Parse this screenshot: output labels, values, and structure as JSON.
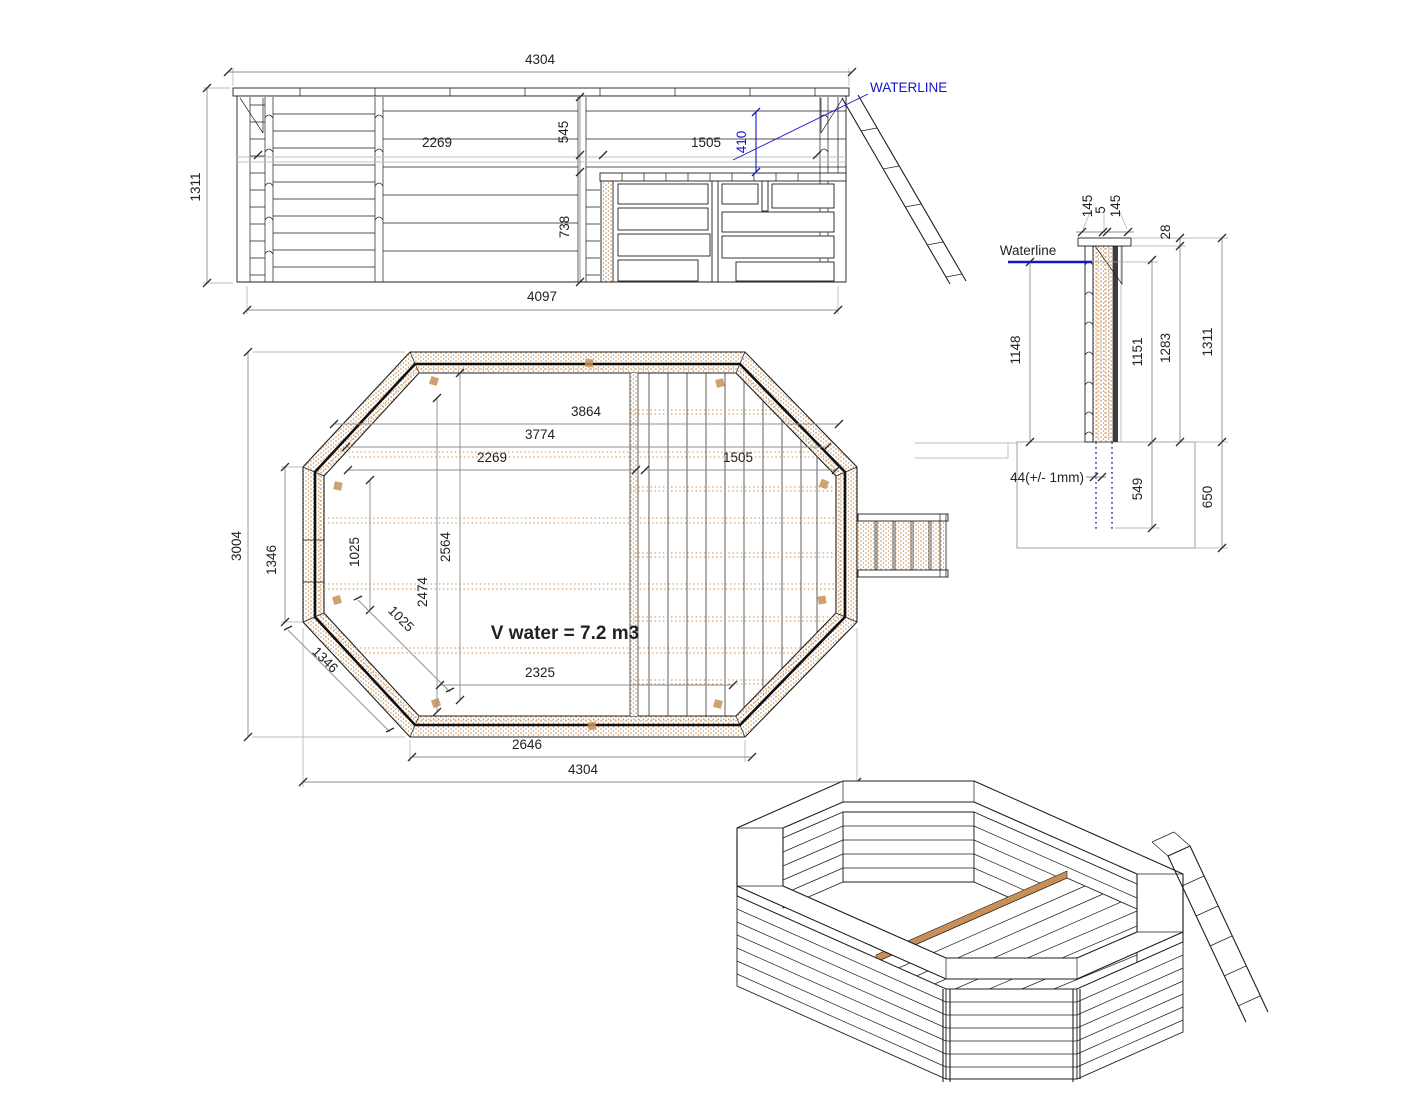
{
  "drawing": {
    "elevation": {
      "total_width": "4304",
      "height": "1311",
      "span_left": "2269",
      "depth_top": "545",
      "span_right": "1505",
      "waterline_offset": "410",
      "depth_bottom": "738",
      "bottom_width": "4097",
      "waterline_label": "WATERLINE"
    },
    "plan": {
      "w3864": "3864",
      "w3774": "3774",
      "w2269": "2269",
      "w1505": "1505",
      "h3004": "3004",
      "edge_left_1346": "1346",
      "v1025": "1025",
      "diag1025": "1025",
      "diag1346": "1346",
      "h2564": "2564",
      "h2474": "2474",
      "volume_note": "V water = 7.2 m3",
      "b2325": "2325",
      "b2646": "2646",
      "b4304": "4304"
    },
    "section": {
      "cap145a": "145",
      "cap5": "5",
      "cap145b": "145",
      "t28": "28",
      "waterline_label": "Waterline",
      "d1148": "1148",
      "d1151": "1151",
      "d1283": "1283",
      "d1311": "1311",
      "d44": "44(+/- 1mm)",
      "d549": "549",
      "d650": "650"
    }
  },
  "colors": {
    "line": "#1f1f1f",
    "dimension": "#8c8c8c",
    "wood": "#c89058",
    "accent_blue": "#1515cf",
    "buried": "#6a62b8",
    "background": "#ffffff"
  }
}
